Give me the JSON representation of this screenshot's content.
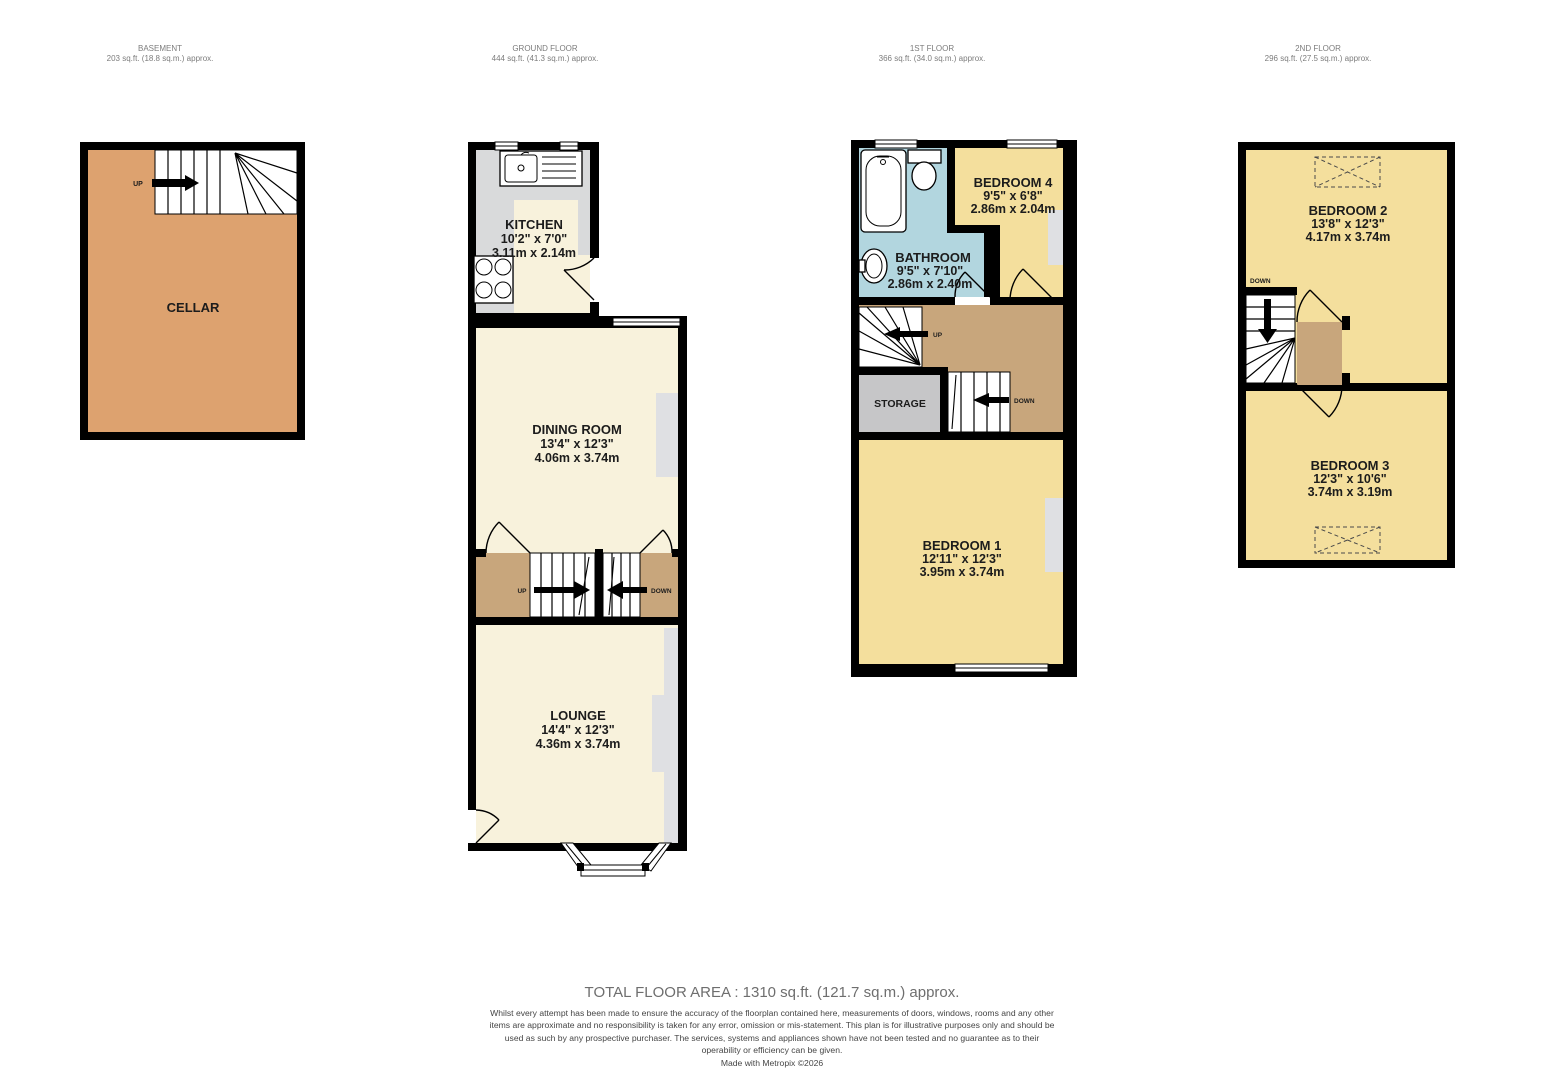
{
  "headers": [
    {
      "title": "BASEMENT",
      "area": "203 sq.ft. (18.8 sq.m.) approx."
    },
    {
      "title": "GROUND FLOOR",
      "area": "444 sq.ft. (41.3 sq.m.) approx."
    },
    {
      "title": "1ST FLOOR",
      "area": "366 sq.ft. (34.0 sq.m.) approx."
    },
    {
      "title": "2ND FLOOR",
      "area": "296 sq.ft. (27.5 sq.m.) approx."
    }
  ],
  "rooms": {
    "cellar": {
      "name": "CELLAR"
    },
    "kitchen": {
      "name": "KITCHEN",
      "imperial": "10'2\"  x 7'0\"",
      "metric": "3.11m  x 2.14m"
    },
    "dining": {
      "name": "DINING ROOM",
      "imperial": "13'4\"  x 12'3\"",
      "metric": "4.06m  x 3.74m"
    },
    "lounge": {
      "name": "LOUNGE",
      "imperial": "14'4\"  x 12'3\"",
      "metric": "4.36m  x 3.74m"
    },
    "bathroom": {
      "name": "BATHROOM",
      "imperial": "9'5\"  x 7'10\"",
      "metric": "2.86m  x 2.40m"
    },
    "bedroom4": {
      "name": "BEDROOM 4",
      "imperial": "9'5\"  x 6'8\"",
      "metric": "2.86m  x 2.04m"
    },
    "bedroom1": {
      "name": "BEDROOM 1",
      "imperial": "12'11\"  x 12'3\"",
      "metric": "3.95m  x 3.74m"
    },
    "bedroom2": {
      "name": "BEDROOM 2",
      "imperial": "13'8\"  x 12'3\"",
      "metric": "4.17m  x 3.74m"
    },
    "bedroom3": {
      "name": "BEDROOM 3",
      "imperial": "12'3\"  x 10'6\"",
      "metric": "3.74m  x 3.19m"
    },
    "storage": {
      "name": "STORAGE"
    }
  },
  "stair_labels": {
    "up": "UP",
    "down": "DOWN"
  },
  "footer": {
    "total": "TOTAL FLOOR AREA : 1310 sq.ft. (121.7 sq.m.) approx.",
    "disclaimer": "Whilst every attempt has been made to ensure the accuracy of the floorplan contained here, measurements of doors, windows, rooms and any other items are approximate and no responsibility is taken for any error, omission or mis-statement. This plan is for illustrative purposes only and should be used as such by any prospective purchaser. The services, systems and appliances shown have not been tested and no guarantee as to their operability or efficiency can be given.",
    "credit": "Made with Metropix ©2026"
  },
  "colors": {
    "wall": "#000000",
    "cream": "#f8f2dc",
    "yellow": "#f4df9d",
    "cellar": "#dda26f",
    "landing": "#c8a67c",
    "bath": "#b2d6df",
    "counter": "#d9dadb",
    "recess": "#dfe0e3",
    "storage": "#c6c6c8"
  }
}
